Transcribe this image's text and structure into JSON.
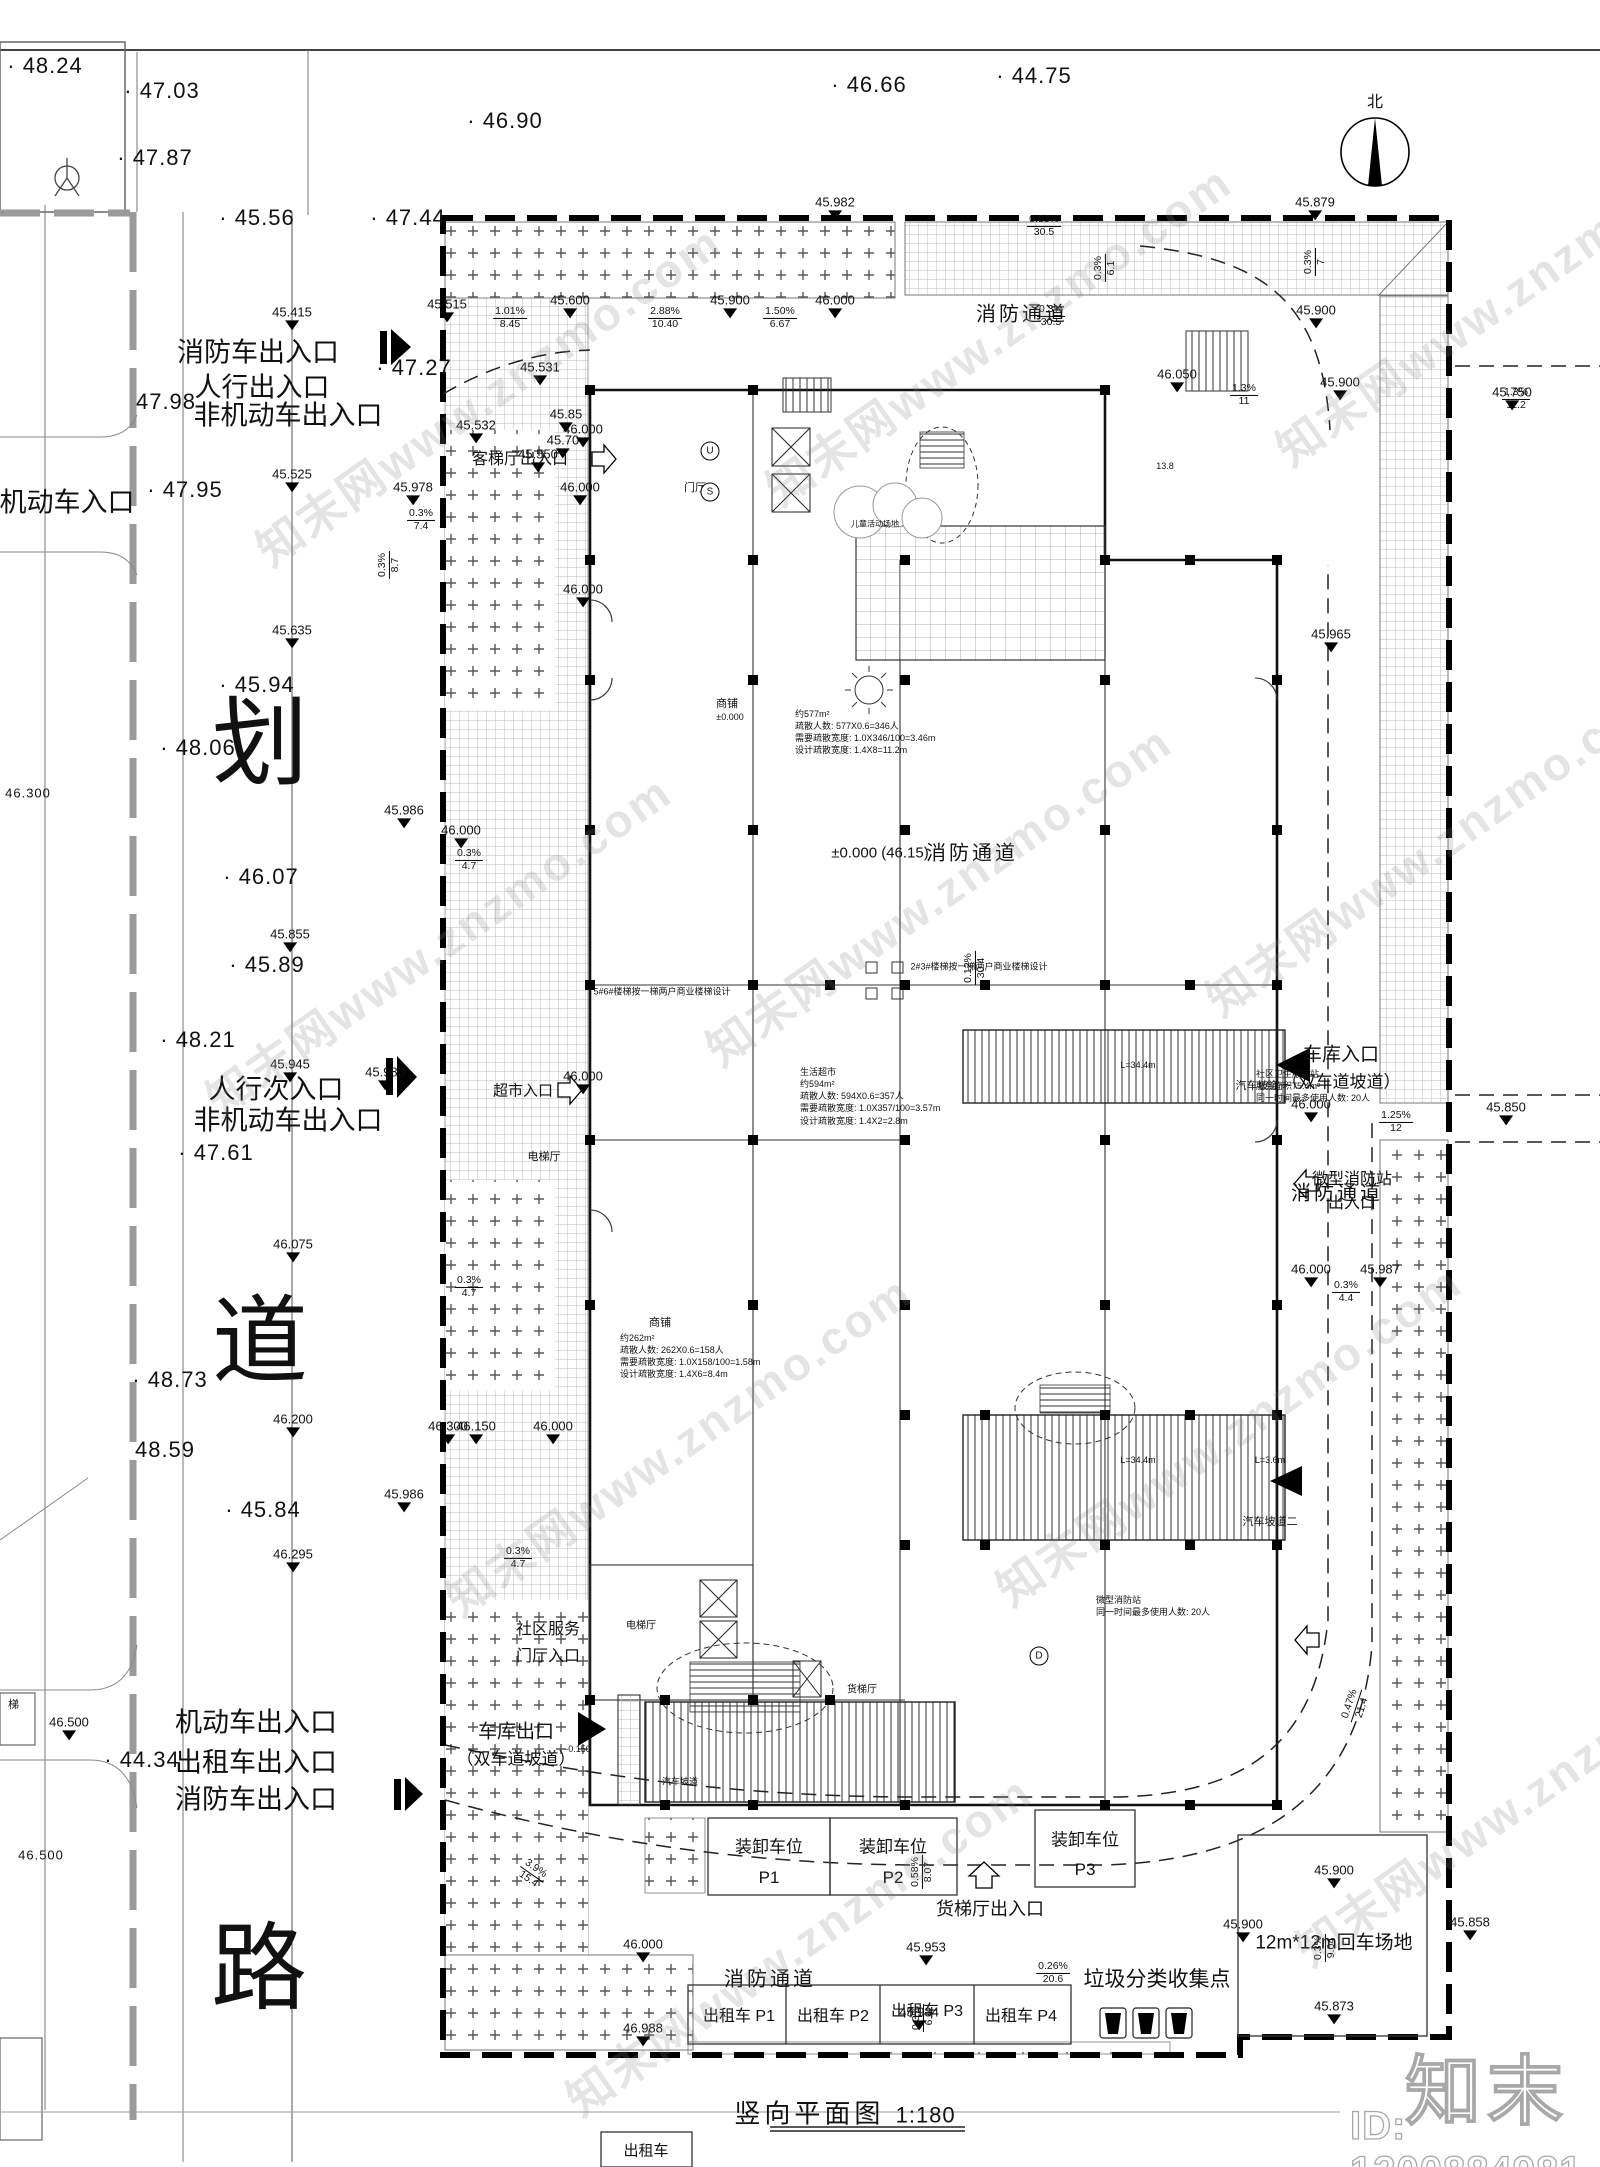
{
  "wm": {
    "diagonal_text": "知末网www.znzmo.com",
    "logo_text": "知末",
    "id_text": "ID: 1200884981"
  },
  "compass": {
    "north_label": "北"
  },
  "title": {
    "text": "竖向平面图",
    "scale": "1:180"
  },
  "road": {
    "chars": [
      {
        "t": "划",
        "x": 260,
        "y": 735
      },
      {
        "t": "道",
        "x": 260,
        "y": 1333
      },
      {
        "t": "路",
        "x": 259,
        "y": 1960
      }
    ]
  },
  "entrances": [
    {
      "t": "消防车出入口",
      "x": 258,
      "y": 350
    },
    {
      "t": "人行出入口",
      "x": 262,
      "y": 385
    },
    {
      "t": "非机动车出入口",
      "x": 288,
      "y": 413
    },
    {
      "t": "机动车入口",
      "x": 67,
      "y": 500
    },
    {
      "t": "人行次入口",
      "x": 276,
      "y": 1087
    },
    {
      "t": "非机动车出入口",
      "x": 288,
      "y": 1118
    },
    {
      "t": "机动车出入口",
      "x": 256,
      "y": 1720
    },
    {
      "t": "出租车出入口",
      "x": 256,
      "y": 1760
    },
    {
      "t": "消防车出入口",
      "x": 256,
      "y": 1797
    }
  ],
  "spots": [
    {
      "t": "· 48.24",
      "x": 45,
      "y": 66
    },
    {
      "t": "· 47.03",
      "x": 162,
      "y": 91
    },
    {
      "t": "· 47.87",
      "x": 155,
      "y": 158
    },
    {
      "t": "· 45.56",
      "x": 257,
      "y": 218
    },
    {
      "t": "· 46.90",
      "x": 505,
      "y": 121
    },
    {
      "t": "· 46.66",
      "x": 869,
      "y": 85
    },
    {
      "t": "· 44.75",
      "x": 1034,
      "y": 76
    },
    {
      "t": "· 47.44",
      "x": 408,
      "y": 218
    },
    {
      "t": "· 47.27",
      "x": 414,
      "y": 368
    },
    {
      "t": "47.98",
      "x": 166,
      "y": 402
    },
    {
      "t": "· 47.95",
      "x": 185,
      "y": 490
    },
    {
      "t": "· 45.94",
      "x": 257,
      "y": 685
    },
    {
      "t": "· 48.06",
      "x": 198,
      "y": 748
    },
    {
      "t": "· 46.07",
      "x": 261,
      "y": 877
    },
    {
      "t": "· 45.89",
      "x": 267,
      "y": 965
    },
    {
      "t": "· 48.21",
      "x": 198,
      "y": 1040
    },
    {
      "t": "· 47.61",
      "x": 216,
      "y": 1153
    },
    {
      "t": "· 48.73",
      "x": 170,
      "y": 1380
    },
    {
      "t": "48.59",
      "x": 165,
      "y": 1450
    },
    {
      "t": "· 45.84",
      "x": 263,
      "y": 1510
    },
    {
      "t": "· 44.34",
      "x": 142,
      "y": 1760
    },
    {
      "t": "46.300",
      "x": 28,
      "y": 793,
      "s": 13
    },
    {
      "t": "46.500",
      "x": 41,
      "y": 1855,
      "s": 13
    },
    {
      "t": "梯",
      "x": 14,
      "y": 1704,
      "s": 11
    }
  ],
  "levels": [
    {
      "v": "45.415",
      "x": 292,
      "y": 330
    },
    {
      "v": "45.525",
      "x": 292,
      "y": 492
    },
    {
      "v": "45.635",
      "x": 292,
      "y": 648
    },
    {
      "v": "45.855",
      "x": 290,
      "y": 952
    },
    {
      "v": "45.945",
      "x": 290,
      "y": 1082
    },
    {
      "v": "46.075",
      "x": 293,
      "y": 1262
    },
    {
      "v": "46.200",
      "x": 293,
      "y": 1437
    },
    {
      "v": "46.295",
      "x": 293,
      "y": 1572
    },
    {
      "v": "46.500",
      "x": 69,
      "y": 1740
    },
    {
      "v": "45.515",
      "x": 447,
      "y": 322
    },
    {
      "v": "45.600",
      "x": 570,
      "y": 318
    },
    {
      "v": "45.900",
      "x": 730,
      "y": 318
    },
    {
      "v": "46.000",
      "x": 835,
      "y": 318
    },
    {
      "v": "45.982",
      "x": 835,
      "y": 220
    },
    {
      "v": "45.879",
      "x": 1315,
      "y": 220
    },
    {
      "v": "45.531",
      "x": 540,
      "y": 385
    },
    {
      "v": "45.532",
      "x": 476,
      "y": 443
    },
    {
      "v": "45.85",
      "x": 566,
      "y": 432
    },
    {
      "v": "45.70",
      "x": 563,
      "y": 458
    },
    {
      "v": "45.550",
      "x": 538,
      "y": 472
    },
    {
      "v": "46.000",
      "x": 580,
      "y": 505
    },
    {
      "v": "45.900",
      "x": 1316,
      "y": 328
    },
    {
      "v": "45.900",
      "x": 1340,
      "y": 400
    },
    {
      "v": "46.050",
      "x": 1177,
      "y": 392
    },
    {
      "v": "45.750",
      "x": 1512,
      "y": 410
    },
    {
      "v": "45.978",
      "x": 413,
      "y": 505
    },
    {
      "v": "45.986",
      "x": 404,
      "y": 828
    },
    {
      "v": "45.980",
      "x": 385,
      "y": 1090
    },
    {
      "v": "45.986",
      "x": 404,
      "y": 1512
    },
    {
      "v": "46.000",
      "x": 583,
      "y": 447
    },
    {
      "v": "46.000",
      "x": 583,
      "y": 607
    },
    {
      "v": "46.000",
      "x": 461,
      "y": 848
    },
    {
      "v": "46.000",
      "x": 583,
      "y": 1094
    },
    {
      "v": "45.965",
      "x": 1331,
      "y": 652
    },
    {
      "v": "46.000",
      "x": 1311,
      "y": 1122
    },
    {
      "v": "45.850",
      "x": 1506,
      "y": 1125
    },
    {
      "v": "46.000",
      "x": 1311,
      "y": 1287
    },
    {
      "v": "45.987",
      "x": 1380,
      "y": 1287
    },
    {
      "v": "46.300",
      "x": 448,
      "y": 1444
    },
    {
      "v": "46.150",
      "x": 476,
      "y": 1444
    },
    {
      "v": "46.000",
      "x": 553,
      "y": 1444
    },
    {
      "v": "46.000",
      "x": 643,
      "y": 1962
    },
    {
      "v": "45.953",
      "x": 926,
      "y": 1965
    },
    {
      "v": "46.988",
      "x": 643,
      "y": 2046
    },
    {
      "v": "45.934",
      "x": 919,
      "y": 2030
    },
    {
      "v": "45.900",
      "x": 1334,
      "y": 1888
    },
    {
      "v": "45.900",
      "x": 1243,
      "y": 1942
    },
    {
      "v": "45.873",
      "x": 1334,
      "y": 2024
    },
    {
      "v": "45.858",
      "x": 1470,
      "y": 1940
    }
  ],
  "slopes": [
    {
      "p": "1.01%",
      "l": "8.45",
      "x": 510,
      "y": 318
    },
    {
      "p": "2.88%",
      "l": "10.40",
      "x": 665,
      "y": 318
    },
    {
      "p": "1.50%",
      "l": "6.67",
      "x": 780,
      "y": 318
    },
    {
      "p": "0.33%",
      "l": "30.5",
      "x": 1044,
      "y": 226
    },
    {
      "p": "0.3%",
      "l": "30.5",
      "x": 1051,
      "y": 316
    },
    {
      "p": "0.3%",
      "l": "6.1",
      "x": 1105,
      "y": 268,
      "r": -90
    },
    {
      "p": "0.3%",
      "l": "7",
      "x": 1315,
      "y": 262,
      "r": -90
    },
    {
      "p": "1.3%",
      "l": "11",
      "x": 1244,
      "y": 395
    },
    {
      "p": "1.3%",
      "l": "11.2",
      "x": 1516,
      "y": 399
    },
    {
      "p": "0.3%",
      "l": "7.4",
      "x": 421,
      "y": 520
    },
    {
      "p": "0.3%",
      "l": "8.7",
      "x": 389,
      "y": 565,
      "r": -90
    },
    {
      "p": "0.3%",
      "l": "4.7",
      "x": 469,
      "y": 860
    },
    {
      "p": "0.3%",
      "l": "4.7",
      "x": 469,
      "y": 1287
    },
    {
      "p": "0.3%",
      "l": "4.7",
      "x": 518,
      "y": 1558
    },
    {
      "p": "0.12%",
      "l": "30.4",
      "x": 975,
      "y": 968,
      "r": -90
    },
    {
      "p": "1.25%",
      "l": "12",
      "x": 1396,
      "y": 1122
    },
    {
      "p": "0.3%",
      "l": "4.4",
      "x": 1346,
      "y": 1292
    },
    {
      "p": "0.58%",
      "l": "8.07",
      "x": 922,
      "y": 1872,
      "r": -90
    },
    {
      "p": "3.9%",
      "l": "15.4",
      "x": 532,
      "y": 1874,
      "r": 35
    },
    {
      "p": "0.26%",
      "l": "20.6",
      "x": 1053,
      "y": 1973
    },
    {
      "p": "0.3%",
      "l": "6.4",
      "x": 923,
      "y": 2018,
      "r": -90
    },
    {
      "p": "0.47%",
      "l": "21.4",
      "x": 1356,
      "y": 1706,
      "r": -72
    },
    {
      "p": "0.3%",
      "l": "9.04",
      "x": 1325,
      "y": 1948,
      "r": -90
    }
  ],
  "lanes": [
    {
      "t": "消防通道",
      "x": 1022,
      "y": 312
    },
    {
      "t": "消防通道",
      "x": 972,
      "y": 851
    },
    {
      "t": "消防通道",
      "x": 1337,
      "y": 1191
    },
    {
      "t": "消防通道",
      "x": 770,
      "y": 1977
    }
  ],
  "rooms": [
    {
      "t": "门厅",
      "x": 695,
      "y": 487,
      "s": 11
    },
    {
      "t": "电梯厅",
      "x": 544,
      "y": 1156,
      "s": 11
    },
    {
      "t": "电梯厅",
      "x": 641,
      "y": 1624,
      "s": 10
    },
    {
      "t": "客梯厅出入口",
      "x": 520,
      "y": 457,
      "s": 16
    },
    {
      "t": "超市入口",
      "x": 523,
      "y": 1090,
      "s": 15
    },
    {
      "t": "商铺",
      "x": 727,
      "y": 703,
      "s": 11
    },
    {
      "t": "±0.000",
      "x": 730,
      "y": 717,
      "s": 9
    },
    {
      "t": "商铺",
      "x": 660,
      "y": 1322,
      "s": 11
    },
    {
      "t": "车库出口",
      "x": 516,
      "y": 1730,
      "s": 19
    },
    {
      "t": "（双车道坡道）",
      "x": 516,
      "y": 1757,
      "s": 17
    },
    {
      "t": "车库入口",
      "x": 1341,
      "y": 1053,
      "s": 19
    },
    {
      "t": "（双车道坡道）",
      "x": 1341,
      "y": 1080,
      "s": 17
    },
    {
      "t": "微型消防站",
      "x": 1352,
      "y": 1177,
      "s": 16
    },
    {
      "t": "出入口",
      "x": 1352,
      "y": 1201,
      "s": 16
    },
    {
      "t": "汽车坡道一",
      "x": 1263,
      "y": 1085,
      "s": 11
    },
    {
      "t": "汽车坡道二",
      "x": 1270,
      "y": 1521,
      "s": 11
    },
    {
      "t": "汽车坡道",
      "x": 680,
      "y": 1781,
      "s": 9
    },
    {
      "t": "L=34.4m",
      "x": 1138,
      "y": 1065,
      "s": 9
    },
    {
      "t": "L=34.4m",
      "x": 1138,
      "y": 1460,
      "s": 9
    },
    {
      "t": "L=3.6m",
      "x": 1270,
      "y": 1460,
      "s": 9
    },
    {
      "t": "货梯厅出入口",
      "x": 990,
      "y": 1908,
      "s": 18
    },
    {
      "t": "货梯厅",
      "x": 862,
      "y": 1688,
      "s": 10
    },
    {
      "t": "垃圾分类收集点",
      "x": 1157,
      "y": 1978,
      "s": 21
    },
    {
      "t": "12m*12m回车场地",
      "x": 1334,
      "y": 1941,
      "s": 19
    },
    {
      "t": "±0.000 (46.15)",
      "x": 880,
      "y": 853,
      "s": 15
    },
    {
      "t": "儿童活动场地",
      "x": 875,
      "y": 524,
      "s": 8
    },
    {
      "t": "13.8",
      "x": 1165,
      "y": 466,
      "s": 9
    },
    {
      "t": "-0.150",
      "x": 578,
      "y": 1749,
      "s": 9
    },
    {
      "t": "社区服务",
      "x": 548,
      "y": 1627,
      "s": 16
    },
    {
      "t": "门厅入口",
      "x": 548,
      "y": 1654,
      "s": 16
    },
    {
      "t": "2#3#楼梯按一梯两户商业楼梯设计",
      "x": 979,
      "y": 966,
      "s": 9
    },
    {
      "t": "5#6#楼梯按一梯两户商业楼梯设计",
      "x": 662,
      "y": 991,
      "s": 9
    }
  ],
  "bubbles": [
    {
      "t": "U",
      "x": 710,
      "y": 451
    },
    {
      "t": "S",
      "x": 710,
      "y": 492
    },
    {
      "t": "D",
      "x": 1039,
      "y": 1656
    }
  ],
  "notes": [
    {
      "x": 795,
      "y": 708,
      "lines": [
        "约577m²",
        "疏散人数: 577X0.6=346人",
        "需要疏散宽度: 1.0X346/100=3.46m",
        "设计疏散宽度: 1.4X8=11.2m"
      ]
    },
    {
      "x": 800,
      "y": 1066,
      "lines": [
        "生活超市",
        "约594m²",
        "疏散人数: 594X0.6=357人",
        "需要疏散宽度: 1.0X357/100=3.57m",
        "设计疏散宽度: 1.4X2=2.8m"
      ]
    },
    {
      "x": 1256,
      "y": 1068,
      "lines": [
        "社区卫生服务站",
        "服务面积75.4m²",
        "同一时间最多使用人数: 20人"
      ]
    },
    {
      "x": 1096,
      "y": 1594,
      "lines": [
        "微型消防站",
        "同一时间最多使用人数: 20人"
      ]
    },
    {
      "x": 620,
      "y": 1332,
      "lines": [
        "约262m²",
        "疏散人数: 262X0.6=158人",
        "需要疏散宽度: 1.0X158/100=1.58m",
        "设计疏散宽度: 1.4X6=8.4m"
      ]
    }
  ],
  "loading": [
    {
      "name": "装卸车位",
      "code": "P1",
      "x": 769,
      "y1": 1845,
      "y2": 1878
    },
    {
      "name": "装卸车位",
      "code": "P2",
      "x": 893,
      "y1": 1845,
      "y2": 1878
    },
    {
      "name": "装卸车位",
      "code": "P3",
      "x": 1085,
      "y1": 1838,
      "y2": 1870
    }
  ],
  "taxi": [
    {
      "t": "出租车 P1",
      "x": 739,
      "y": 2014
    },
    {
      "t": "出租车 P2",
      "x": 833,
      "y": 2014
    },
    {
      "t": "出租车 P3",
      "x": 927,
      "y": 2009
    },
    {
      "t": "出租车 P4",
      "x": 1021,
      "y": 2014
    }
  ],
  "taxi_stand": {
    "t": "出租车",
    "x": 646,
    "y": 2150
  }
}
